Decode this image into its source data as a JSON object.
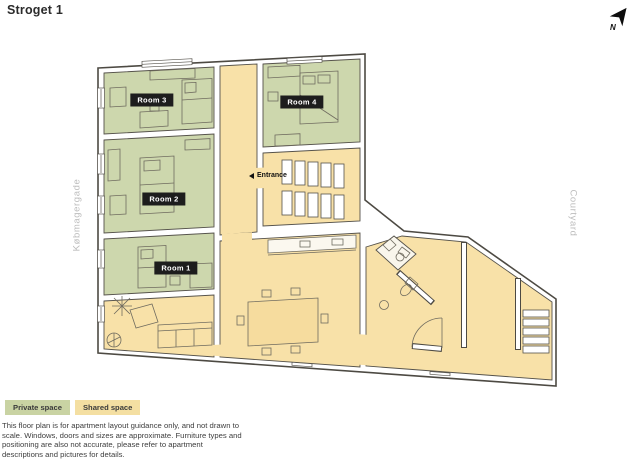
{
  "header": {
    "title": "Stroget 1"
  },
  "compass": {
    "label": "N",
    "icon": "north-arrow"
  },
  "plan": {
    "street_label_left": "Købmagergade",
    "street_label_right": "Courtyard",
    "entrance_label": "Entrance",
    "rooms": [
      {
        "id": "room-3",
        "label": "Room 3",
        "type": "private"
      },
      {
        "id": "room-2",
        "label": "Room 2",
        "type": "private"
      },
      {
        "id": "room-1",
        "label": "Room 1",
        "type": "private"
      },
      {
        "id": "room-4",
        "label": "Room 4",
        "type": "private"
      }
    ],
    "shared_areas": [
      "hallway",
      "entrance-staircase",
      "kitchen-dining",
      "living-room",
      "bathrooms",
      "corridor",
      "back-staircase"
    ]
  },
  "legend": {
    "items": [
      {
        "label": "Private space",
        "color": "#c9d3a3"
      },
      {
        "label": "Shared space",
        "color": "#f4dfa2"
      }
    ]
  },
  "disclaimer": "This floor plan is for apartment layout guidance only, and not drawn to scale. Windows, doors and sizes are approximate. Furniture types and positioning are also not accurate, please refer to apartment descriptions and pictures for details.",
  "colors": {
    "private_space_floor": "#cdd7ad",
    "shared_space_floor": "#f8e1a8",
    "bathroom_floor": "#f9f6ec",
    "wall_fill": "#ffffff",
    "wall_outline": "#4d4a43",
    "room_label_bg": "#1d1d1d",
    "street_label_text": "#bcbcbc"
  }
}
